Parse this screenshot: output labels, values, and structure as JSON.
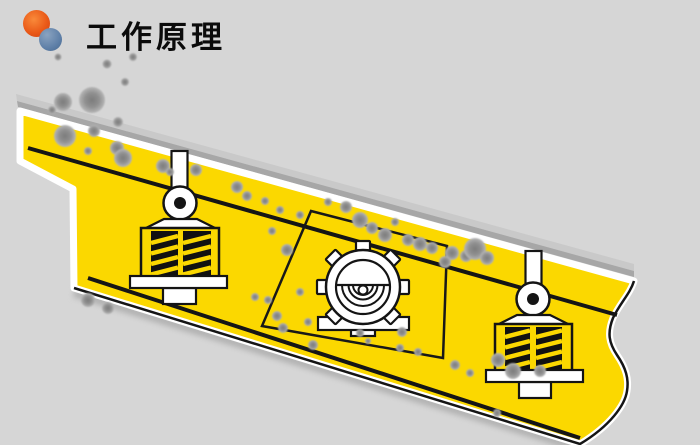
{
  "header": {
    "title": "工作原理",
    "logo": {
      "orange": "#ea5a18",
      "blue": "#5f80a8"
    }
  },
  "colors": {
    "background": "#d6d6d6",
    "body_yellow": "#fbd800",
    "strip_light": "#c9c9c9",
    "strip_dark": "#a7a7a7",
    "line_black": "#151515",
    "part_white": "#ffffff",
    "particle_core": "#7c7c7c",
    "particle_edge": "#b6b6b6"
  },
  "diagram": {
    "machine": "inclined-vibrating-screen",
    "components": [
      "feed-material-layer",
      "screen-deck",
      "vibration-exciter",
      "spring-damper-left",
      "spring-damper-right",
      "material-particles"
    ],
    "particles": [
      [
        58,
        57,
        3.5
      ],
      [
        107,
        64,
        4.5
      ],
      [
        133,
        57,
        4
      ],
      [
        125,
        82,
        4
      ],
      [
        63,
        102,
        9
      ],
      [
        92,
        100,
        13
      ],
      [
        52,
        110,
        4
      ],
      [
        118,
        122,
        5
      ],
      [
        65,
        136,
        11
      ],
      [
        94,
        131,
        6
      ],
      [
        117,
        148,
        7
      ],
      [
        88,
        151,
        4
      ],
      [
        123,
        158,
        9
      ],
      [
        163,
        166,
        7
      ],
      [
        196,
        170,
        6
      ],
      [
        170,
        172,
        4
      ],
      [
        237,
        187,
        6
      ],
      [
        247,
        196,
        5
      ],
      [
        265,
        201,
        4
      ],
      [
        280,
        210,
        4
      ],
      [
        300,
        215,
        4
      ],
      [
        328,
        202,
        4
      ],
      [
        346,
        207,
        6
      ],
      [
        360,
        220,
        8
      ],
      [
        372,
        228,
        6
      ],
      [
        385,
        235,
        7
      ],
      [
        395,
        222,
        4
      ],
      [
        408,
        240,
        6
      ],
      [
        420,
        244,
        7
      ],
      [
        432,
        248,
        6
      ],
      [
        452,
        253,
        7
      ],
      [
        466,
        256,
        6
      ],
      [
        475,
        249,
        11
      ],
      [
        487,
        258,
        7
      ],
      [
        445,
        262,
        6
      ],
      [
        287,
        250,
        6
      ],
      [
        272,
        231,
        4
      ],
      [
        300,
        292,
        4
      ],
      [
        255,
        297,
        4
      ],
      [
        268,
        300,
        4
      ],
      [
        277,
        316,
        5
      ],
      [
        283,
        328,
        5
      ],
      [
        308,
        322,
        4
      ],
      [
        313,
        345,
        5
      ],
      [
        360,
        333,
        4
      ],
      [
        368,
        341,
        3
      ],
      [
        402,
        332,
        5
      ],
      [
        400,
        348,
        4
      ],
      [
        418,
        352,
        4
      ],
      [
        455,
        365,
        5
      ],
      [
        470,
        373,
        4
      ],
      [
        498,
        360,
        7
      ],
      [
        513,
        371,
        8
      ],
      [
        540,
        371,
        6
      ],
      [
        497,
        413,
        4
      ],
      [
        88,
        300,
        7
      ],
      [
        108,
        308,
        6
      ]
    ]
  }
}
